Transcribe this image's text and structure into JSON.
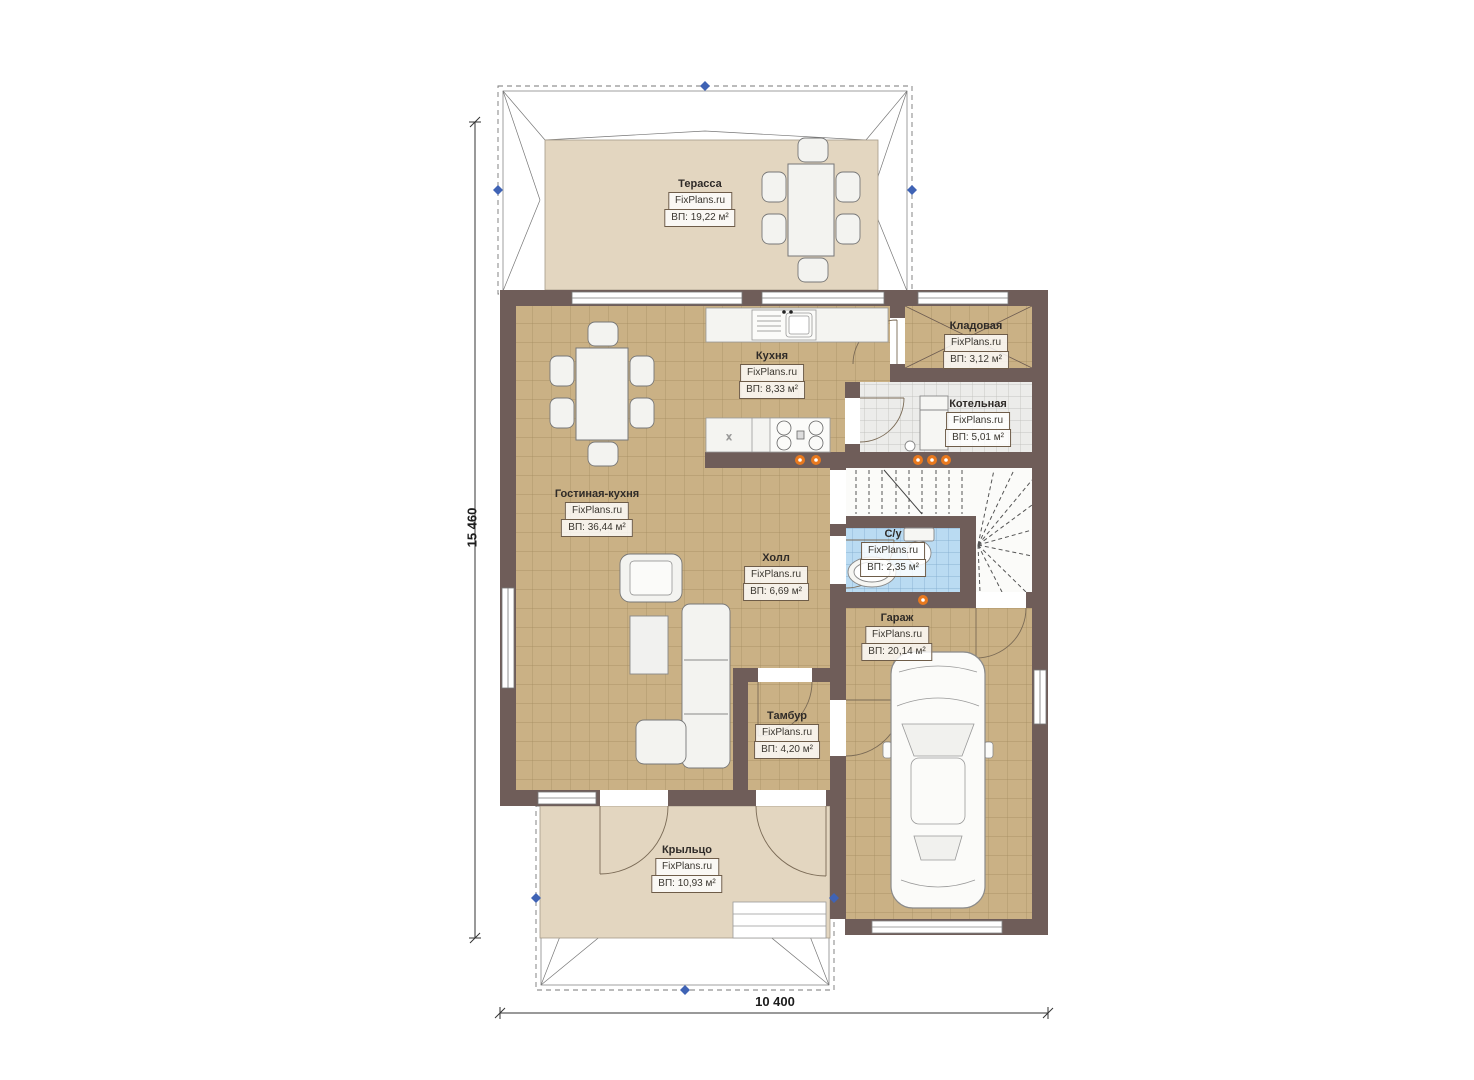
{
  "plan": {
    "brand": "FixPlans.ru",
    "dimensions": {
      "vertical": "15 460",
      "horizontal": "10 400"
    },
    "rooms": [
      {
        "name": "Терасса",
        "area": "ВП: 19,22 м²"
      },
      {
        "name": "Кухня",
        "area": "ВП: 8,33 м²"
      },
      {
        "name": "Кладовая",
        "area": "ВП: 3,12 м²"
      },
      {
        "name": "Котельная",
        "area": "ВП: 5,01 м²"
      },
      {
        "name": "Гостиная-кухня",
        "area": "ВП: 36,44 м²"
      },
      {
        "name": "Холл",
        "area": "ВП: 6,69 м²"
      },
      {
        "name": "С/у",
        "area": "ВП: 2,35 м²"
      },
      {
        "name": "Гараж",
        "area": "ВП: 20,14 м²"
      },
      {
        "name": "Тамбур",
        "area": "ВП: 4,20 м²"
      },
      {
        "name": "Крыльцо",
        "area": "ВП: 10,93 м²"
      }
    ],
    "symbols": {
      "stove_mark": "x"
    },
    "colors": {
      "wall": "#6f5d59",
      "tile_floor": "#cab185",
      "terrace_floor": "#e3d6c0",
      "bath_tile": "#badbf2",
      "utility_floor": "#ececea",
      "accent_dot": "#e8791e",
      "marker_blue": "#3f63b5"
    }
  }
}
